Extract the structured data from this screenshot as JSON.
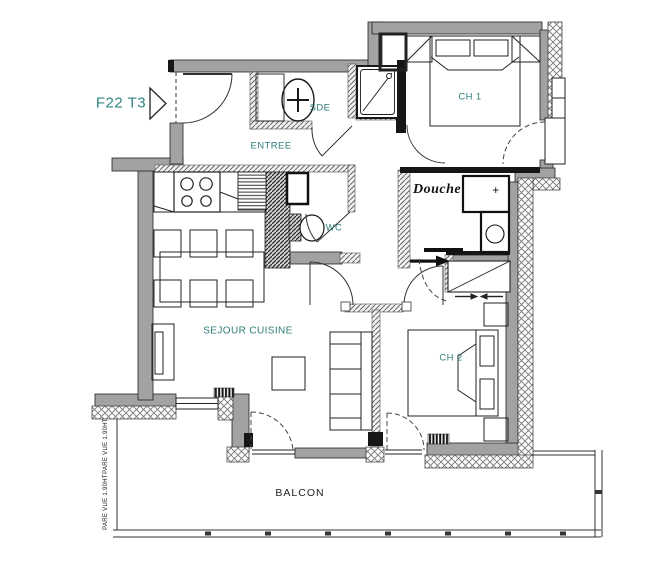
{
  "plan": {
    "unit_label": "F22 T3",
    "colors": {
      "label_teal": "#2e7d7a",
      "wall_gray": "#a2a2a2",
      "ink": "#1a1a1a"
    },
    "rooms": [
      {
        "id": "entree",
        "label": "ENTREE"
      },
      {
        "id": "sde",
        "label": "SDE"
      },
      {
        "id": "ch1",
        "label": "CH 1"
      },
      {
        "id": "douche",
        "label": "Douche"
      },
      {
        "id": "wc",
        "label": "WC"
      },
      {
        "id": "sejour",
        "label": "SEJOUR CUISINE"
      },
      {
        "id": "ch2",
        "label": "CH 2"
      },
      {
        "id": "balcon",
        "label": "BALCON"
      }
    ],
    "annotations": {
      "pare_vue_upper": "PARE VUE 1.90HT",
      "pare_vue_lower": "PARE VUE 1.90HT",
      "washbasin_plus": "+"
    }
  }
}
